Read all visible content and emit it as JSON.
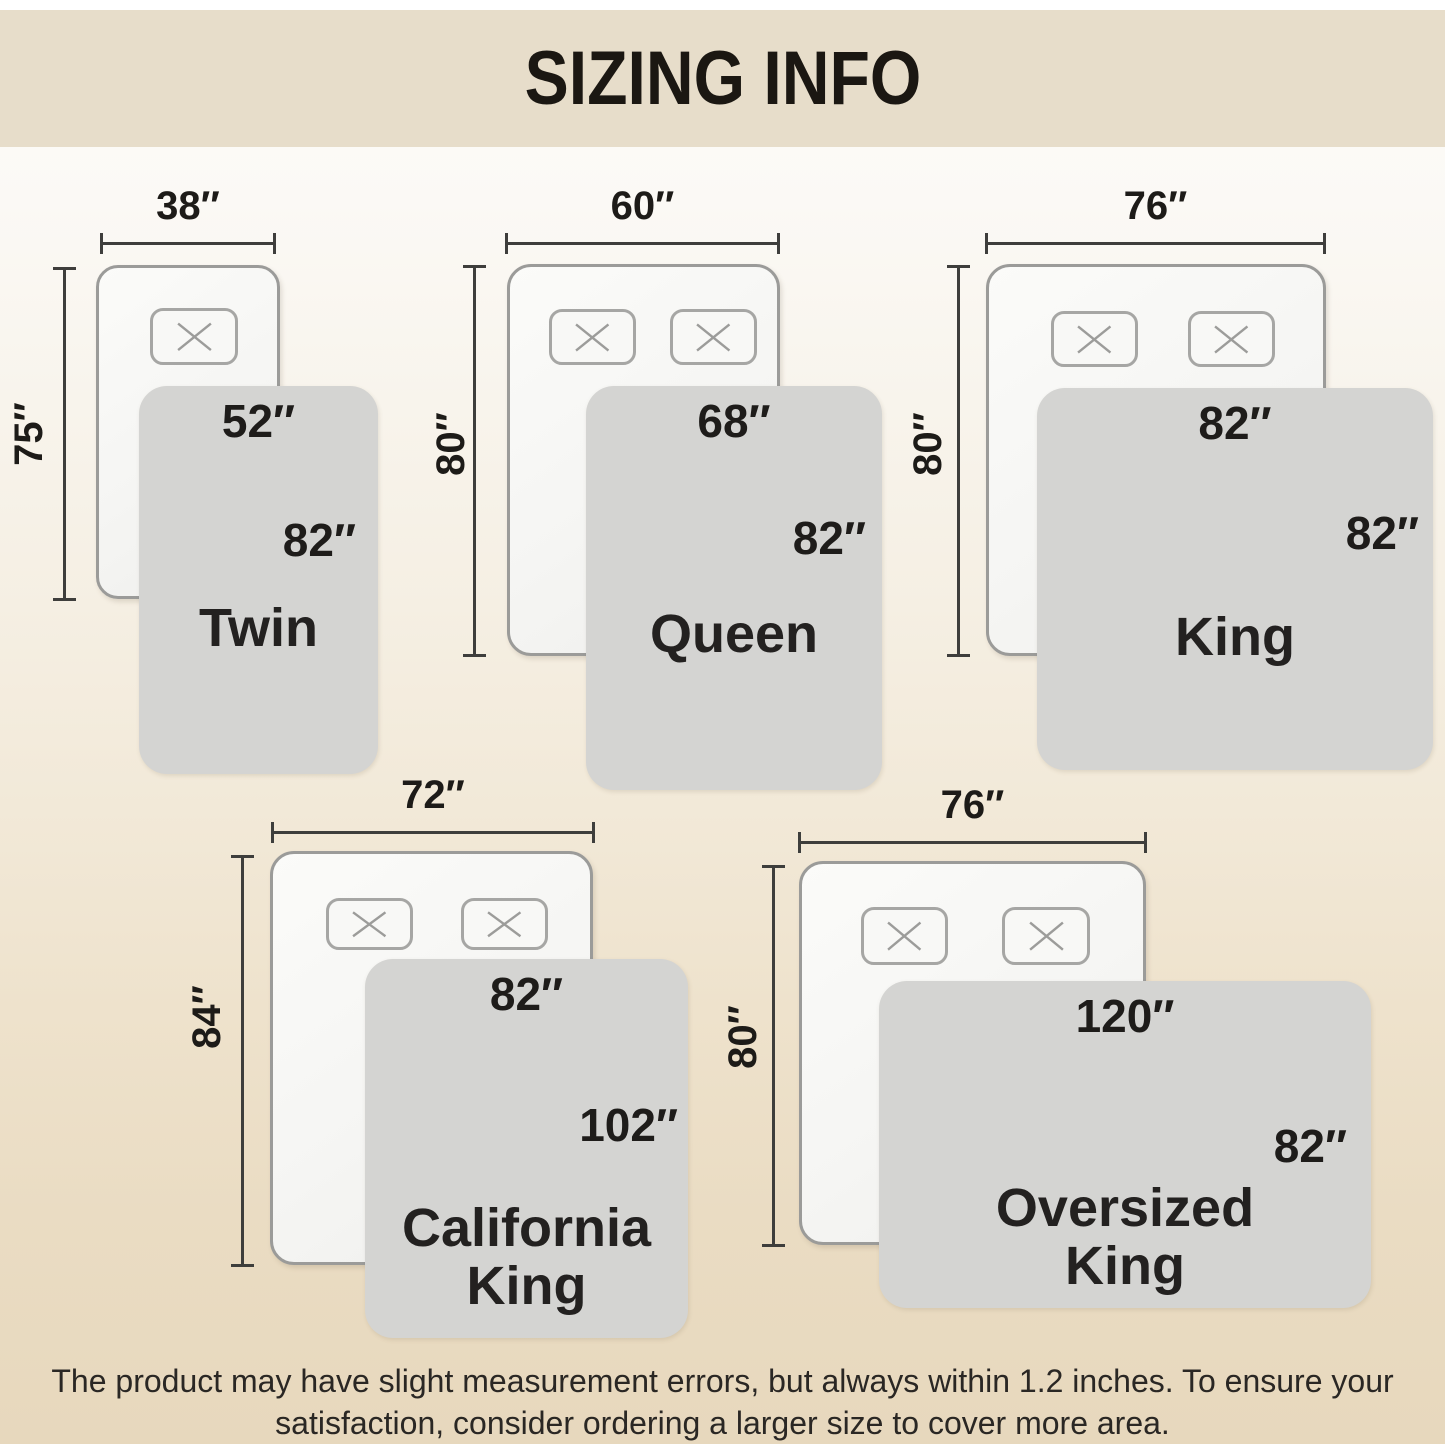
{
  "title": "SIZING INFO",
  "beds": [
    {
      "name": "Twin",
      "bed_width": "38″",
      "bed_length": "75″",
      "blanket_width": "52″",
      "blanket_length": "82″"
    },
    {
      "name": "Queen",
      "bed_width": "60″",
      "bed_length": "80″",
      "blanket_width": "68″",
      "blanket_length": "82″"
    },
    {
      "name": "King",
      "bed_width": "76″",
      "bed_length": "80″",
      "blanket_width": "82″",
      "blanket_length": "82″"
    },
    {
      "name": "California King",
      "bed_width": "72″",
      "bed_length": "84″",
      "blanket_width": "82″",
      "blanket_length": "102″"
    },
    {
      "name": "Oversized King",
      "bed_width": "76″",
      "bed_length": "80″",
      "blanket_width": "120″",
      "blanket_length": "82″"
    }
  ],
  "disclaimer": {
    "line1": "The product may have slight measurement errors, but always within 1.2 inches. To ensure your",
    "line2": "satisfaction, consider ordering a larger size to cover more area."
  },
  "colors": {
    "header_bg": "#e7ddca",
    "blanket": "#d4d4d2",
    "mattress": "#f7f7f5",
    "dimension_line": "#3e3e3c",
    "text": "#1d1b18"
  }
}
